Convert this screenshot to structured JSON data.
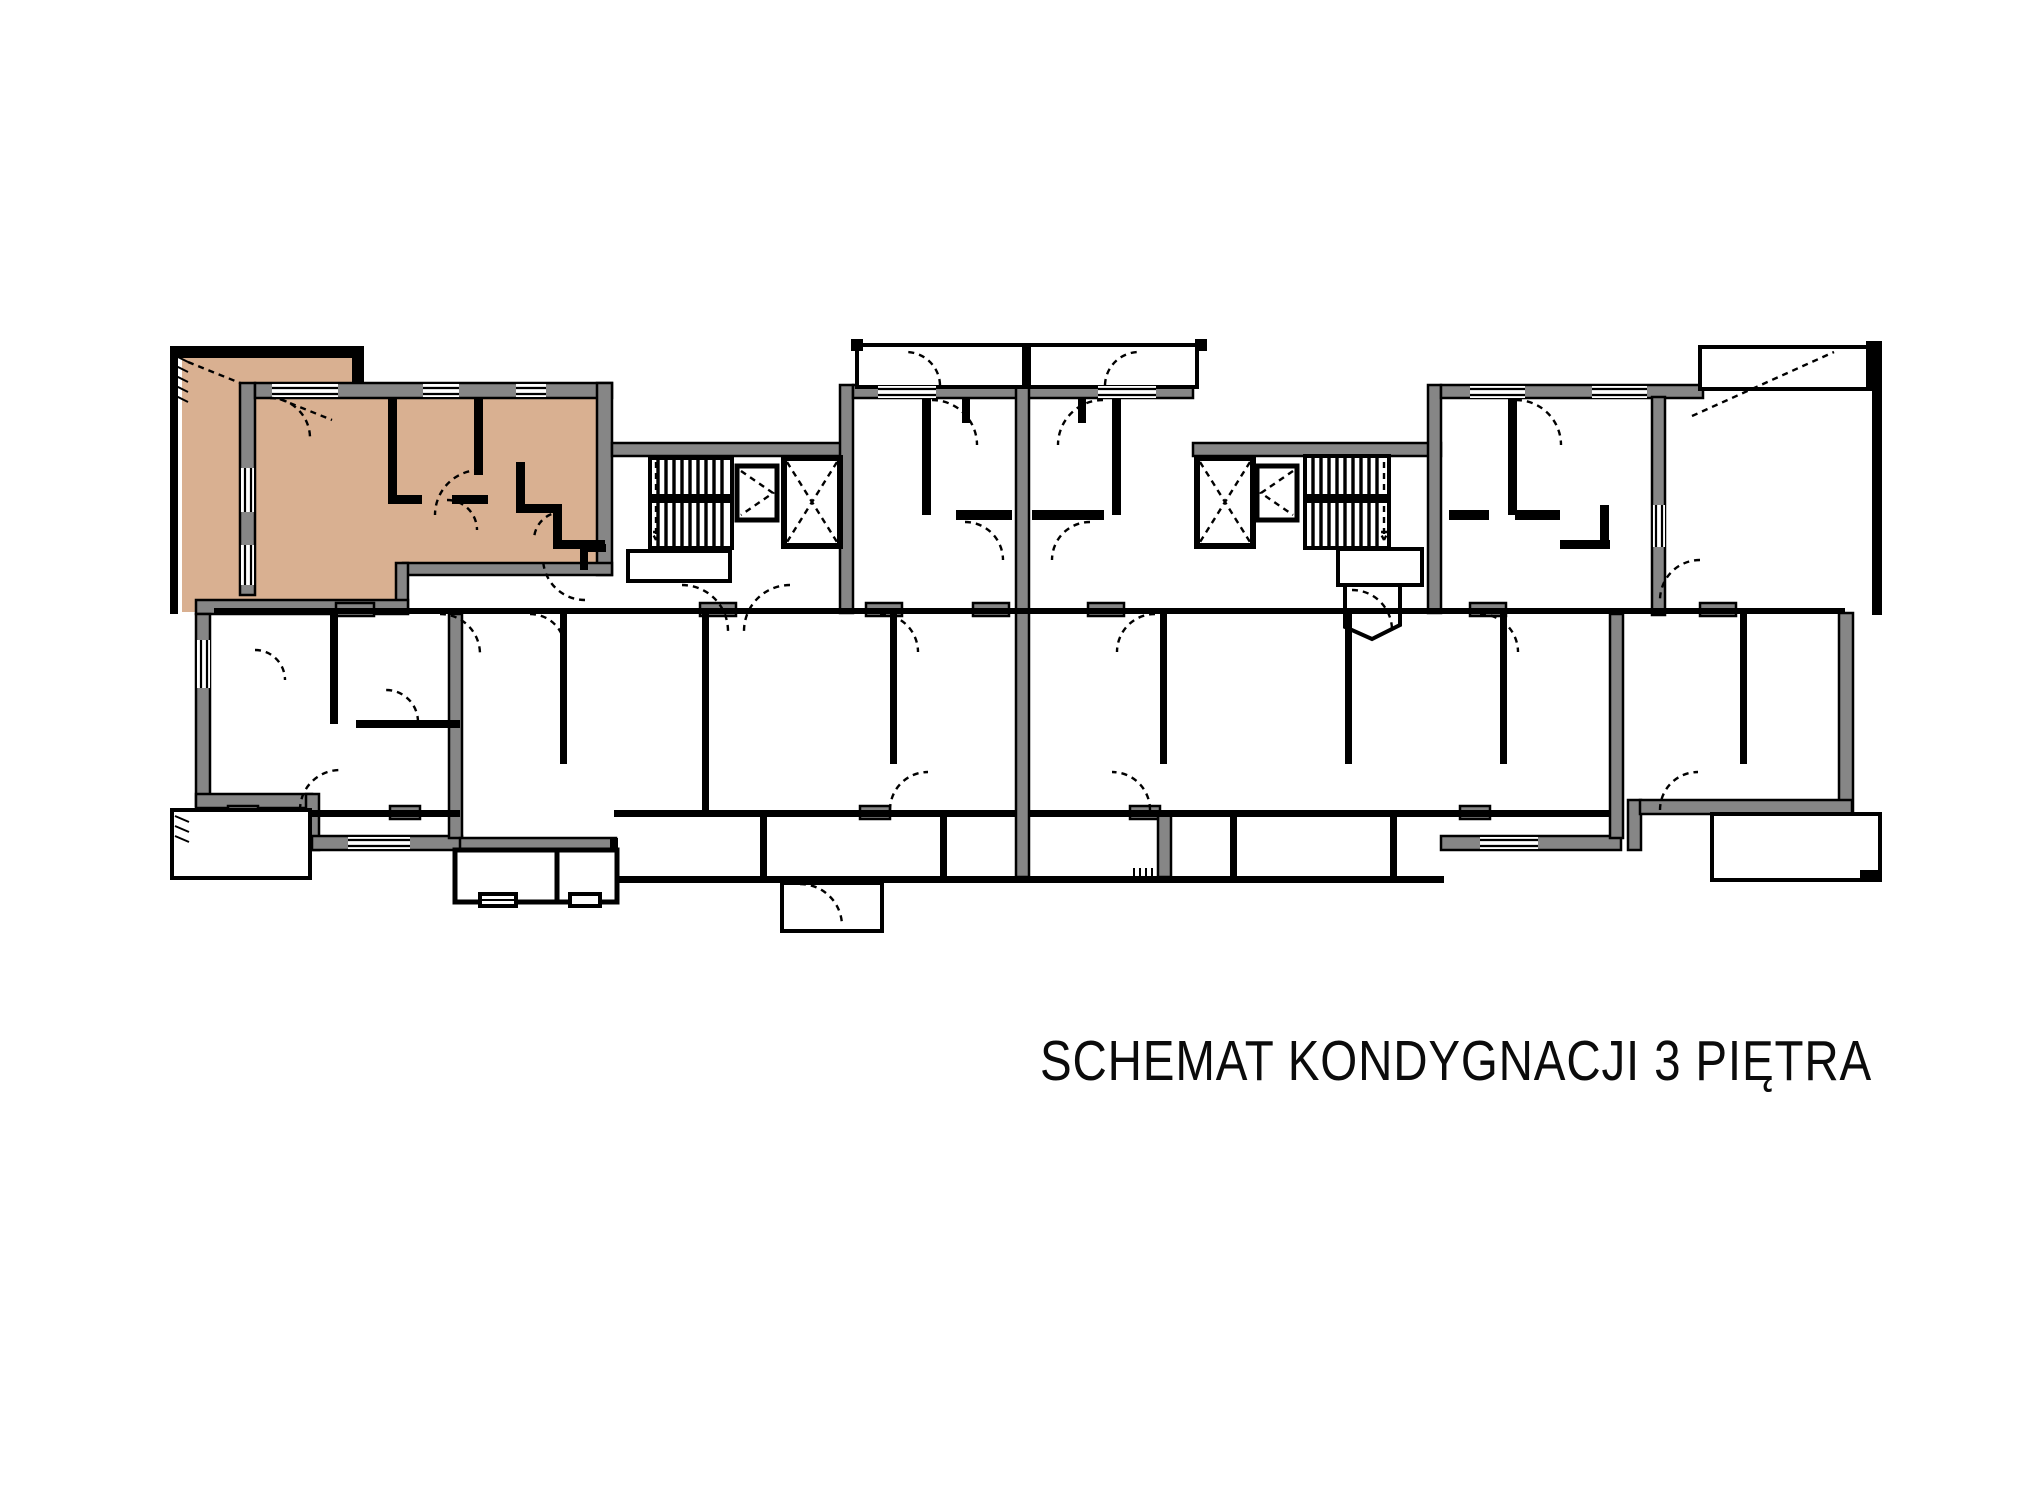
{
  "title": "SCHEMAT KONDYGNACJI 3 PIĘTRA",
  "floor_label": "3",
  "colors": {
    "highlight": "#d9b091",
    "wall": "#868686",
    "line": "#000000",
    "bg": "#ffffff"
  },
  "highlighted_unit": {
    "description": "selected apartment, top-left wing with terrace",
    "fill": "#d9b091"
  }
}
